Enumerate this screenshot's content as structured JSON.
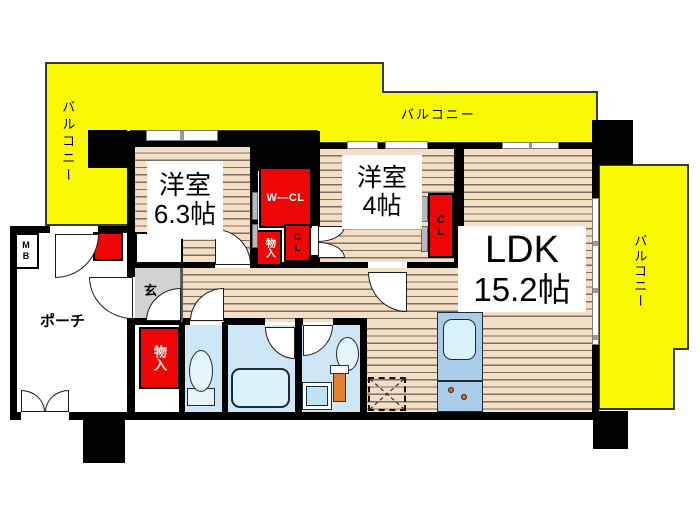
{
  "plan": {
    "type": "apartment-floorplan",
    "labels": {
      "balcony_left": "バルコニー",
      "balcony_top": "バルコニー",
      "balcony_right": "バルコニー",
      "bedroom1_name": "洋室",
      "bedroom1_size": "6.3帖",
      "bedroom2_name": "洋室",
      "bedroom2_size": "4帖",
      "ldk_name": "LDK",
      "ldk_size": "15.2帖",
      "porch": "ポーチ",
      "entrance": "玄",
      "walkin_closet": "W—CL",
      "closet_hall": "CL",
      "closet_ldk": "CL",
      "storage_hall": "物入",
      "storage_entry": "物入",
      "meter_box": "M\nB"
    },
    "colors": {
      "balcony_yellow": "#f8f800",
      "wall_black": "#000000",
      "closet_red": "#ee0505",
      "wet_room_blue": "#cde7f7",
      "fixture_blue": "#e4f5fc",
      "counter_blue": "#a9cde8",
      "genkan_gray": "#d2d2d2",
      "wood_base": "#f3dfc6",
      "wood_line": "#7e6e60",
      "burner_orange": "#d2691e"
    }
  }
}
